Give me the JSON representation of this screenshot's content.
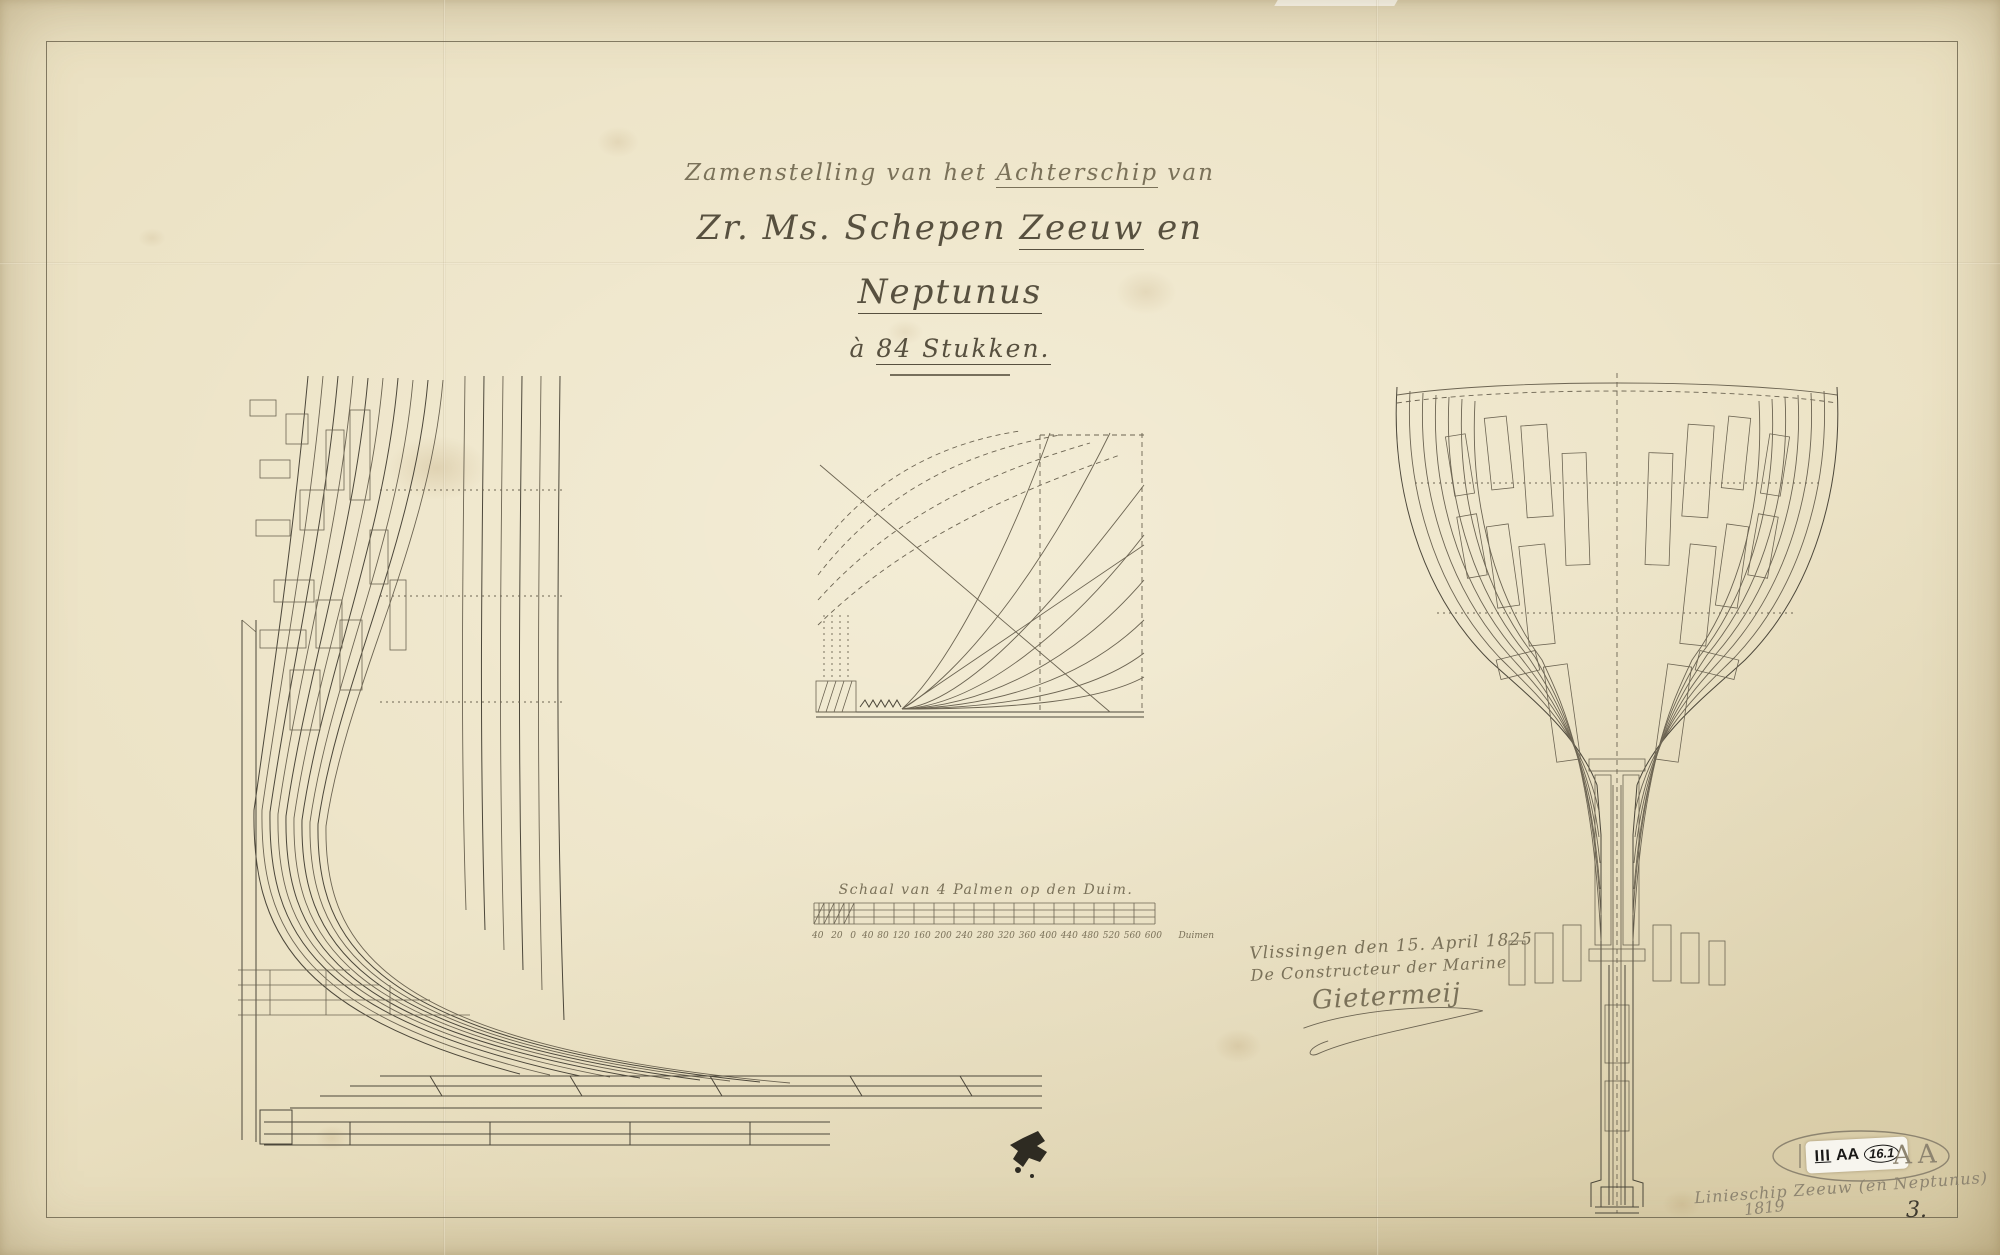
{
  "colors": {
    "paper": "#eae0c1",
    "paper_edge": "#d5c8a2",
    "ink": "#57503f",
    "ink_light": "#7a7159",
    "draw": "#4c473a",
    "draw_light": "#6c6452",
    "pencil": "#8d8470",
    "sticker": "#f7f5ee",
    "blot": "#2e2b22",
    "border_line": "#6f6753"
  },
  "title": {
    "line1_pre": "Zamenstelling van het ",
    "line1_underlined": "Achterschip",
    "line1_post": " van",
    "line2_pre": "Zr. Ms. Schepen ",
    "line2_underlined1": "Zeeuw",
    "line2_mid": " en ",
    "line2_underlined2": "Neptunus",
    "line3_pre": "à ",
    "line3_underlined": "84 Stukken."
  },
  "scale": {
    "caption": "Schaal van 4 Palmen op den Duim.",
    "left_labels": [
      "40",
      "20",
      "0"
    ],
    "tick_labels": [
      "40",
      "80",
      "120",
      "160",
      "200",
      "240",
      "280",
      "320",
      "360",
      "400",
      "440",
      "480",
      "520",
      "560",
      "600"
    ],
    "unit": "Duimen"
  },
  "signature_block": {
    "place_date": "Vlissingen den 15. April 1825",
    "function": "De Constructeur der Marine",
    "signature": "Gietermeij"
  },
  "stamp": {
    "series": "III",
    "letters": "AA",
    "number": "16.1",
    "pencil_letters": "AA"
  },
  "annotations": {
    "pencil_line1": "Linieschip Zeeuw (en Neptunus)",
    "pencil_line2": "1819",
    "sheet_number": "3."
  }
}
